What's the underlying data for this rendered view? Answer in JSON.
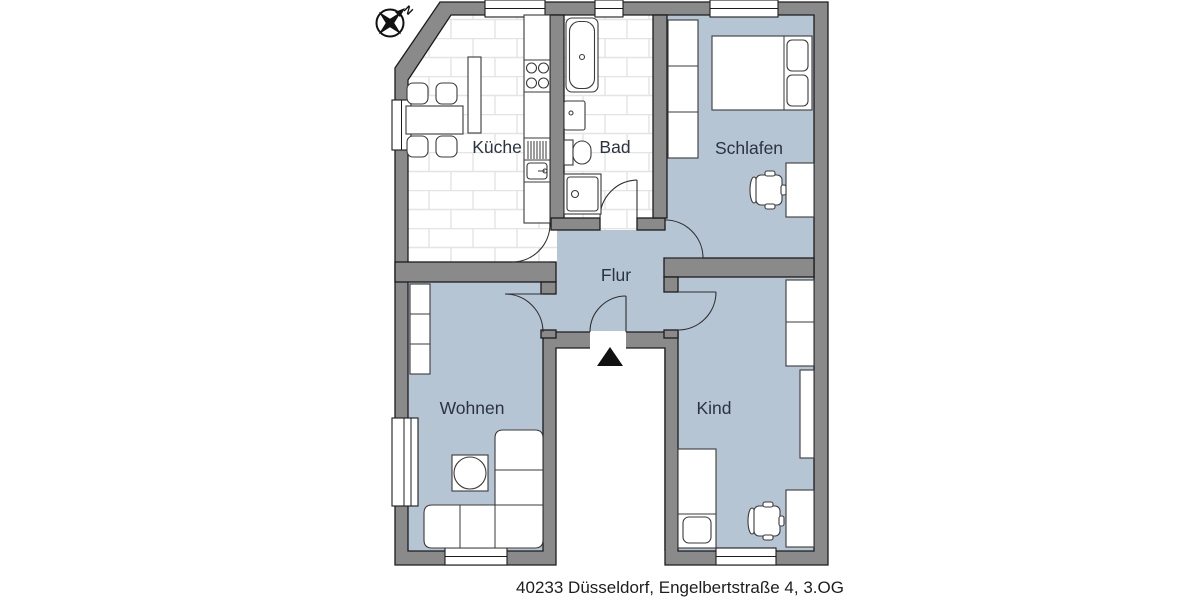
{
  "footer": {
    "address": "40233 Düsseldorf, Engelbertstraße 4, 3.OG"
  },
  "compass": {
    "north": "N"
  },
  "rooms": {
    "kueche": "Küche",
    "bad": "Bad",
    "schlafen": "Schlafen",
    "flur": "Flur",
    "wohnen": "Wohnen",
    "kind": "Kind"
  },
  "colors": {
    "wall": "#8a8a8a",
    "floor": "#b6c5d4",
    "tile_line": "#e4e4e4",
    "furniture_fill": "#ffffff",
    "outline": "#1c1c1c",
    "background": "#ffffff",
    "label": "#2b3340"
  }
}
